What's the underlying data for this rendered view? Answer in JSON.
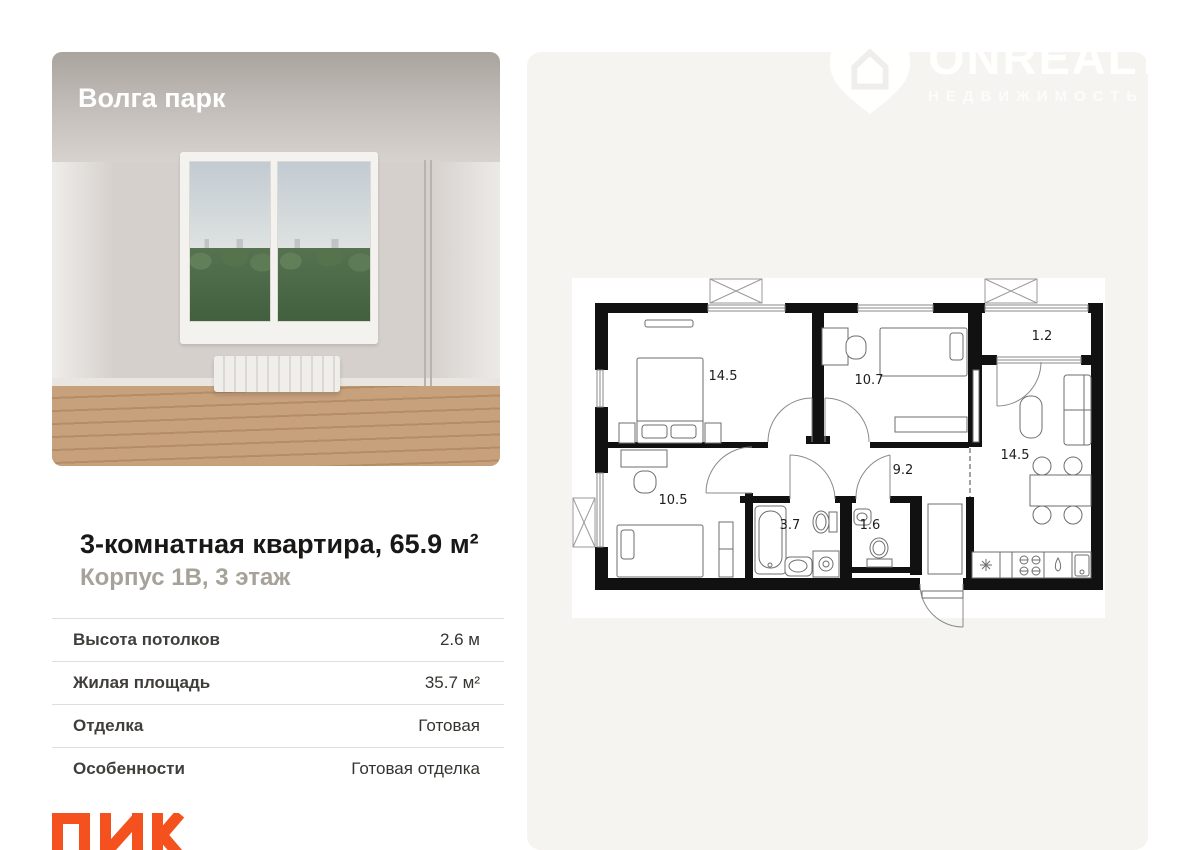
{
  "project": {
    "name": "Волга парк"
  },
  "watermark": {
    "brand": "ONREALT",
    "tagline": "НЕДВИЖИМОСТЬ",
    "icon": "house-pin-icon"
  },
  "listing": {
    "title": "3-комнатная квартира, 65.9 м²",
    "subtitle": "Корпус 1В, 3 этаж",
    "specs": [
      {
        "label": "Высота потолков",
        "value": "2.6 м"
      },
      {
        "label": "Жилая площадь",
        "value": "35.7 м²"
      },
      {
        "label": "Отделка",
        "value": "Готовая"
      },
      {
        "label": "Особенности",
        "value": "Готовая отделка"
      }
    ],
    "developer": "ПИК"
  },
  "floorplan": {
    "room_areas": {
      "bedroom_main": "14.5",
      "bedroom_second": "10.7",
      "balcony": "1.2",
      "kitchen_living": "14.5",
      "hallway": "9.2",
      "bedroom_third": "10.5",
      "bathroom": "3.7",
      "wc": "1.6"
    }
  },
  "colors": {
    "developer_accent": "#F4511E",
    "panel_background": "#F5F4F1",
    "plan_walls": "#111111"
  }
}
